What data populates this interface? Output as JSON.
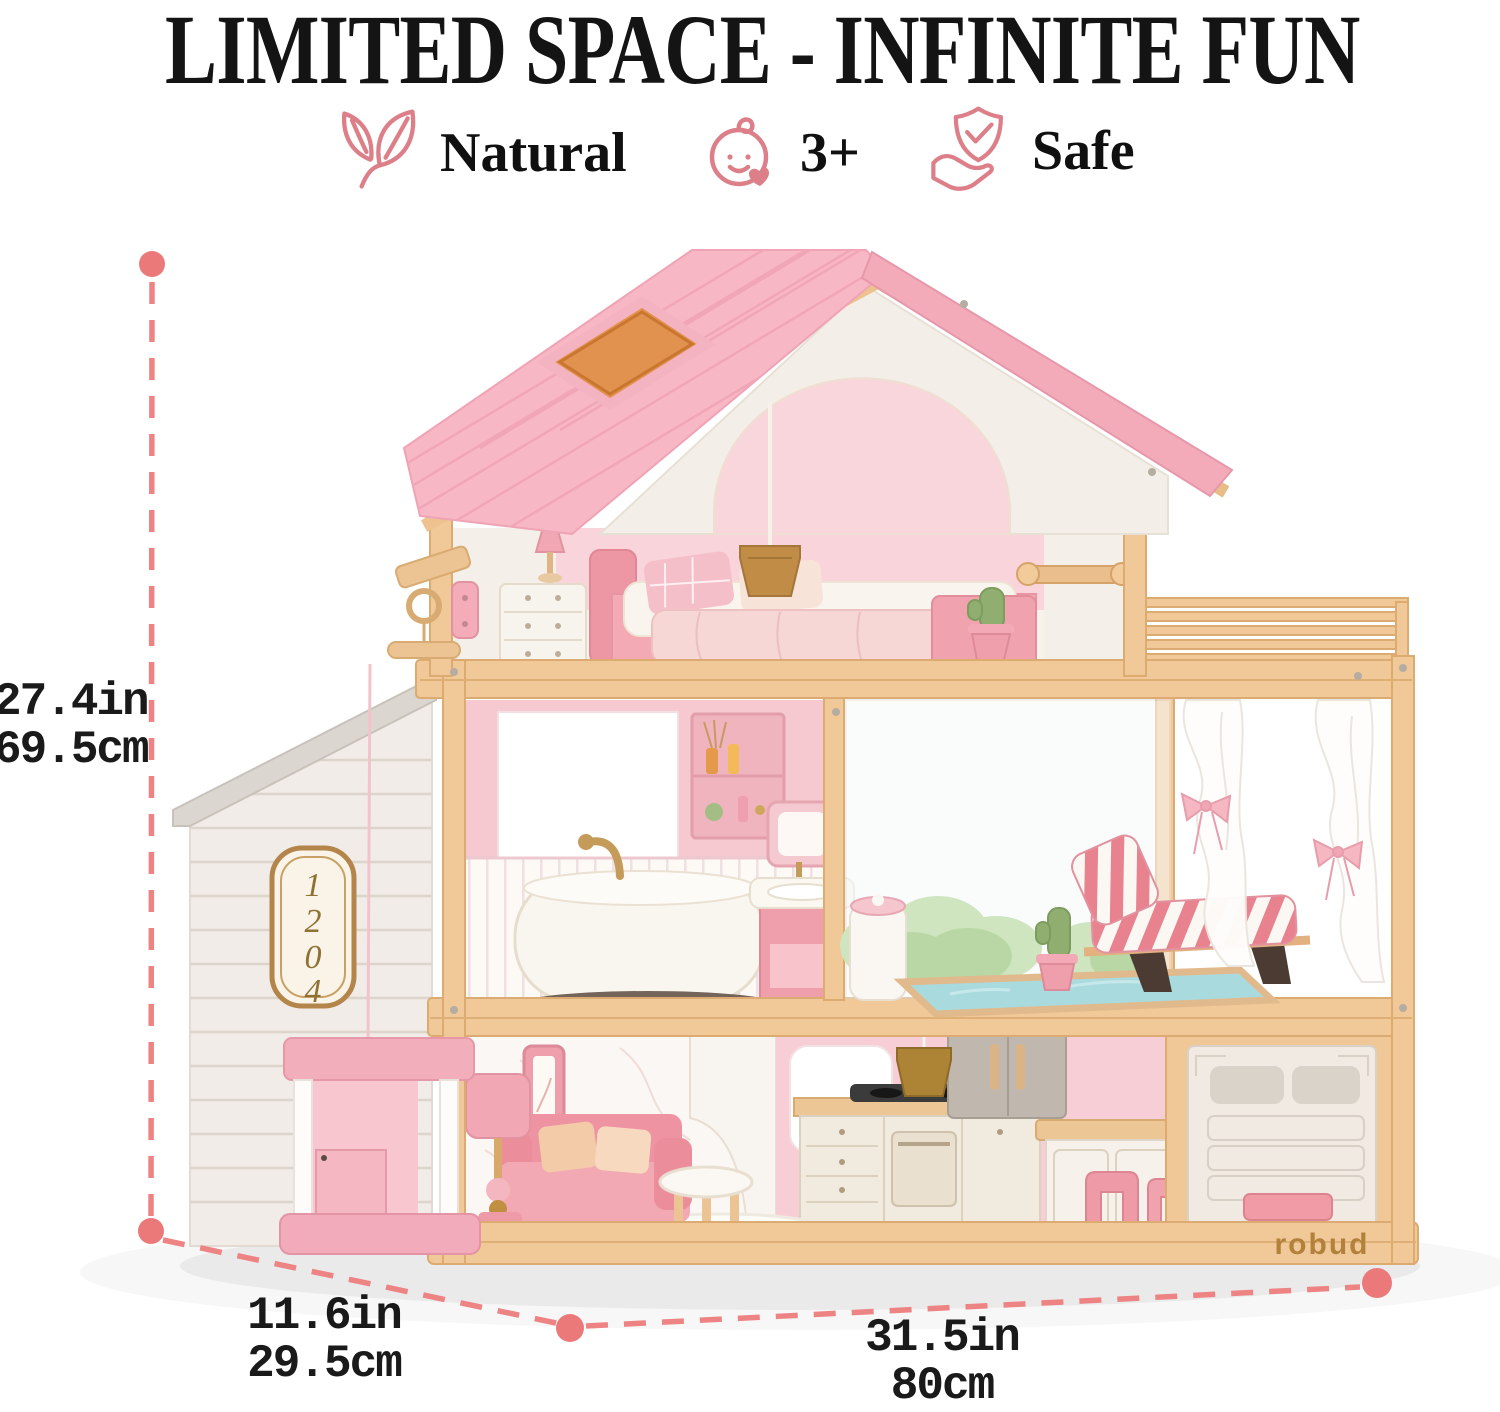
{
  "title": "LIMITED SPACE - INFINITE FUN",
  "features": [
    {
      "icon": "leaf-icon",
      "label": "Natural"
    },
    {
      "icon": "baby-icon",
      "label": "3+"
    },
    {
      "icon": "shield-check-icon",
      "label": "Safe"
    }
  ],
  "dimensions": {
    "height": {
      "inches": "27.4in",
      "metric": "69.5cm"
    },
    "depth": {
      "inches": "11.6in",
      "metric": "29.5cm"
    },
    "width": {
      "inches": "31.5in",
      "metric": "80cm"
    }
  },
  "product": {
    "brand": "robud",
    "fridge_brand": "robud",
    "house_number": "1204",
    "house_number_digits": [
      "1",
      "2",
      "0",
      "4"
    ]
  },
  "colors": {
    "accent_dimension": "#ed8383",
    "icon_pink": "#dc7f89",
    "roof_pink": "#f8b7c4",
    "wood": "#f1c897",
    "pool_blue": "#a9dbde",
    "brand_gold": "#b2823c",
    "text": "#1a1a1a"
  }
}
